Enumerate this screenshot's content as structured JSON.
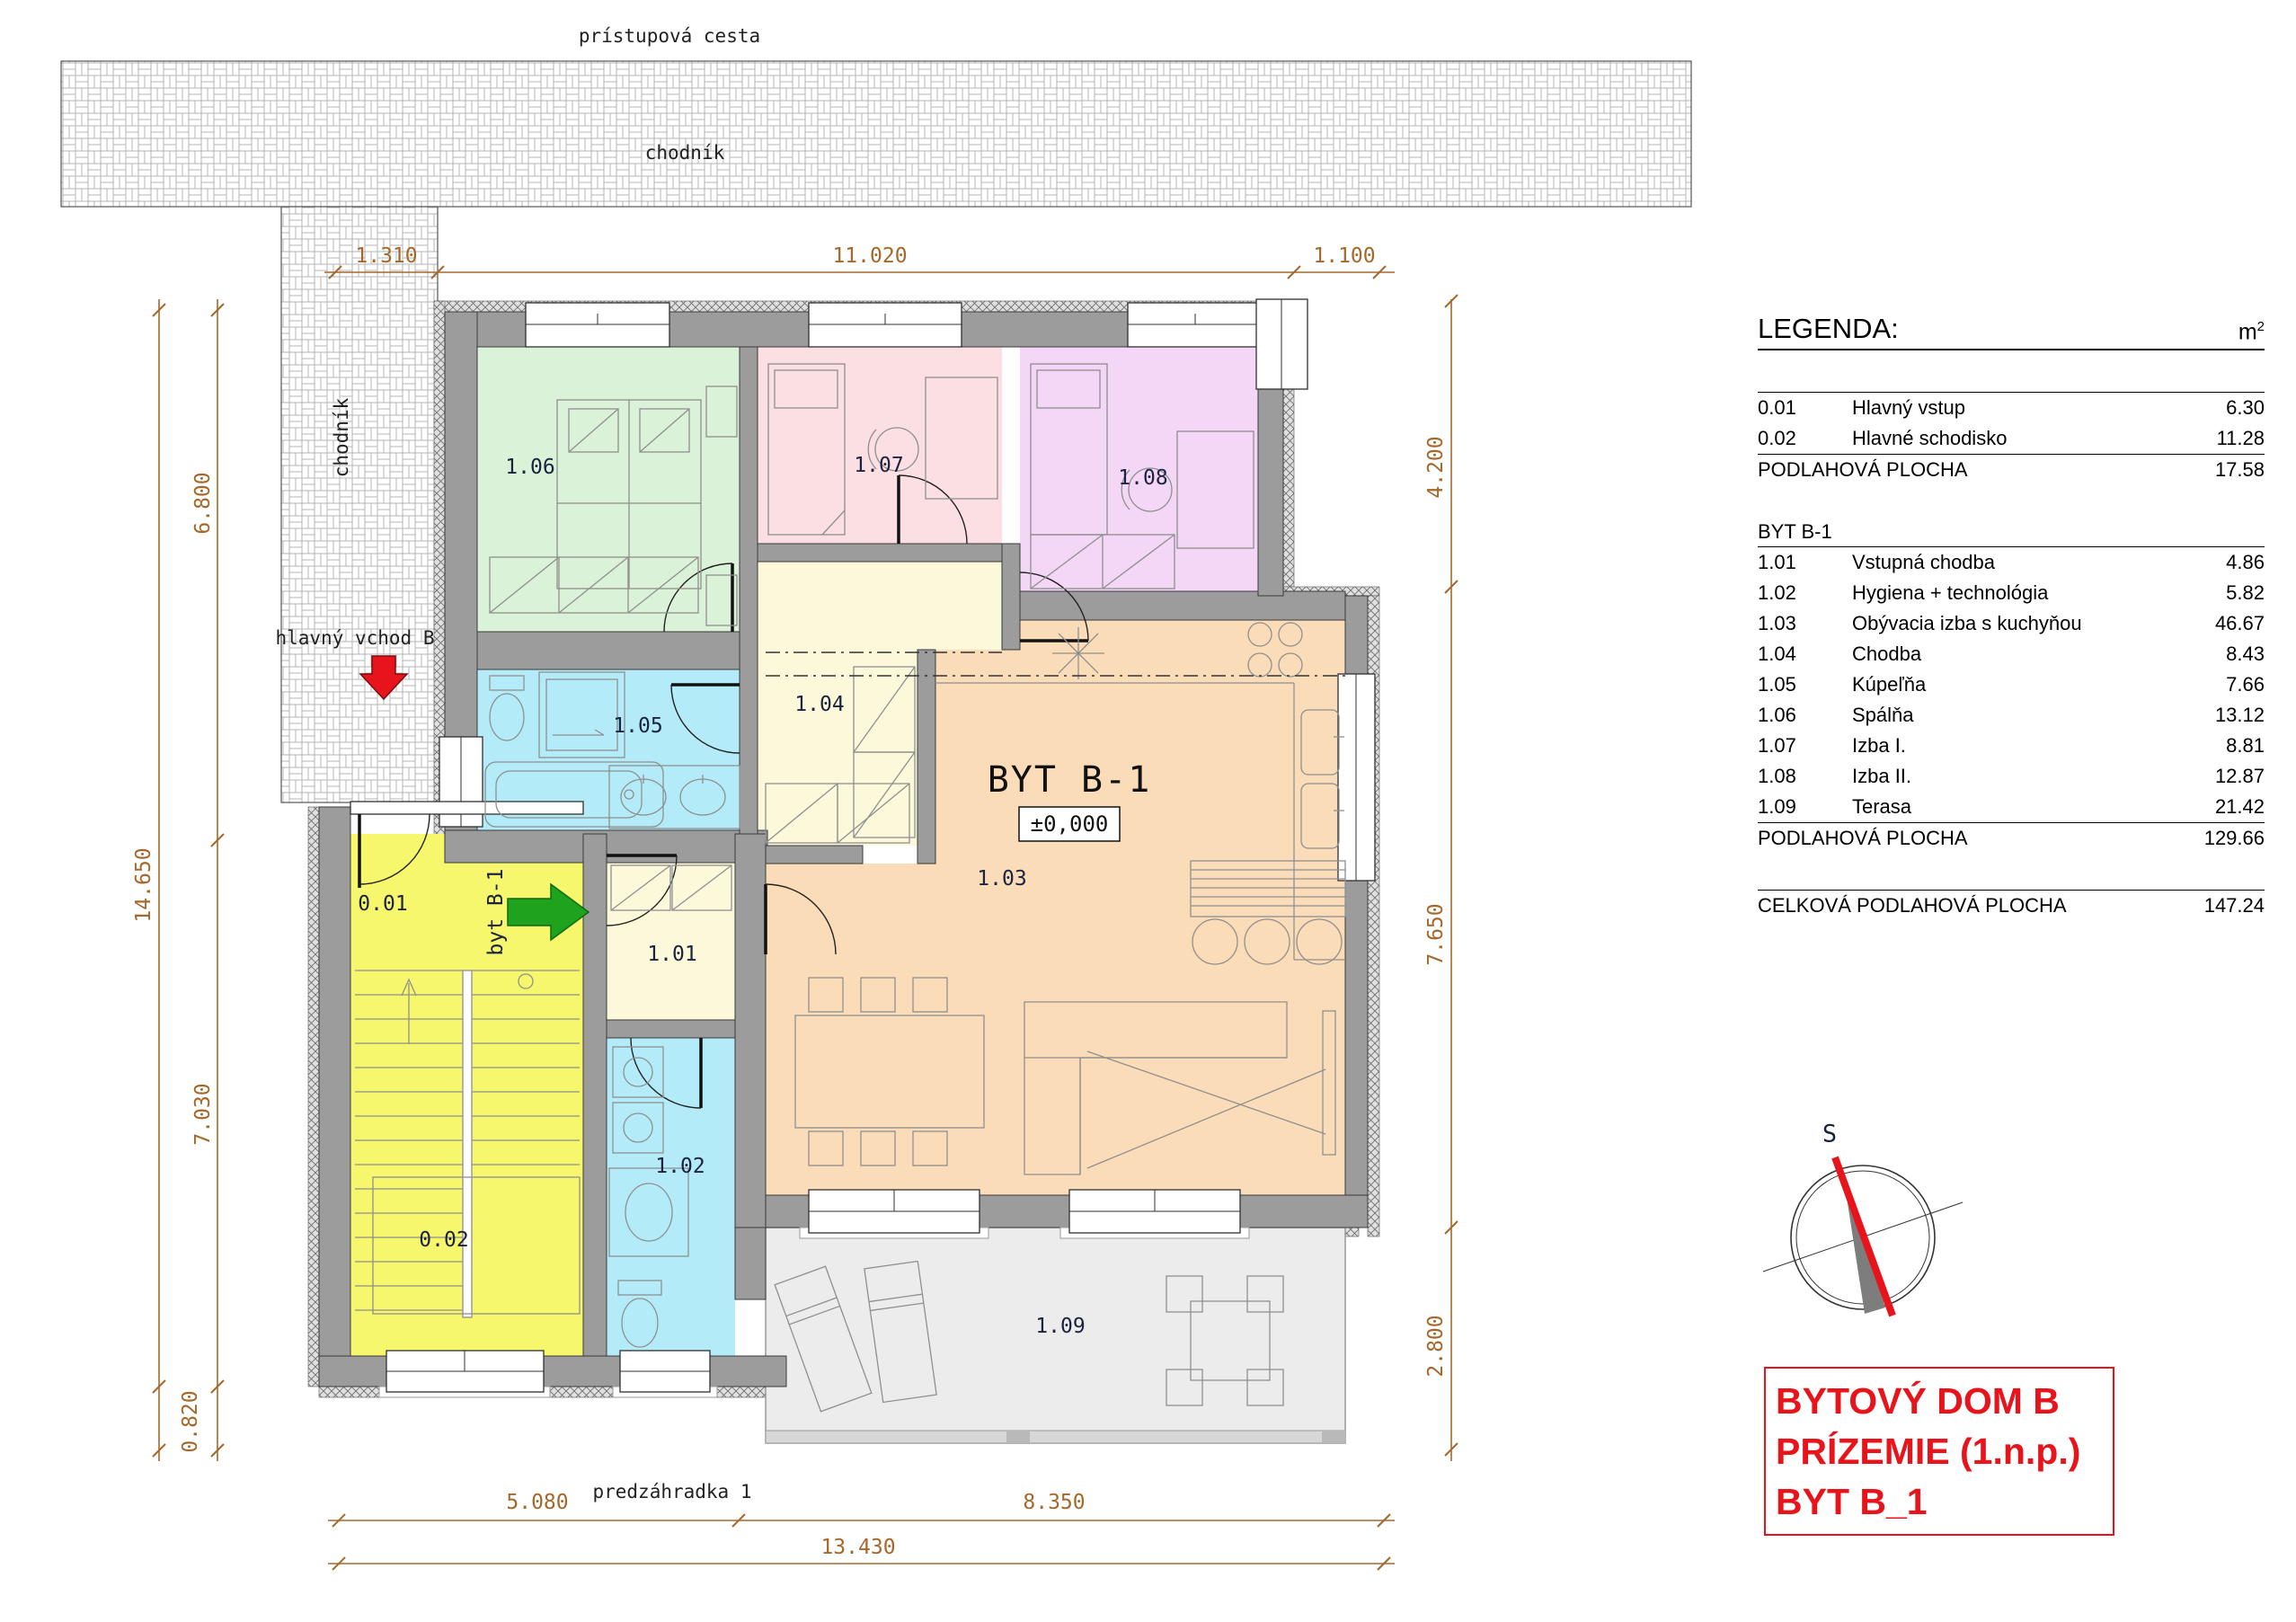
{
  "site": {
    "access_road": "prístupová cesta",
    "sidewalk_top": "chodník",
    "sidewalk_left": "chodník",
    "main_entrance": "hlavný vchod B",
    "front_garden": "predzáhradka 1"
  },
  "apartment": {
    "title": "BYT B-1",
    "level": "±0,000",
    "entry_arrow_label": "byt B-1"
  },
  "rooms": {
    "r001": {
      "code": "0.01",
      "color": "#f7f76d"
    },
    "r002": {
      "code": "0.02",
      "color": "#f7f76d"
    },
    "r101": {
      "code": "1.01",
      "color": "#fcf9da"
    },
    "r102": {
      "code": "1.02",
      "color": "#b3ecf8"
    },
    "r103": {
      "code": "1.03",
      "color": "#fadcb8"
    },
    "r104": {
      "code": "1.04",
      "color": "#fcf9da"
    },
    "r105": {
      "code": "1.05",
      "color": "#b3ecf8"
    },
    "r106": {
      "code": "1.06",
      "color": "#daf2d7"
    },
    "r107": {
      "code": "1.07",
      "color": "#fbdfe3"
    },
    "r108": {
      "code": "1.08",
      "color": "#f4d7f6"
    },
    "r109": {
      "code": "1.09",
      "color": "#ececec"
    }
  },
  "dims": {
    "d1310": "1.310",
    "d11020": "11.020",
    "d1100": "1.100",
    "d14650": "14.650",
    "d6800": "6.800",
    "d7030": "7.030",
    "d0820": "0.820",
    "d4200": "4.200",
    "d7650": "7.650",
    "d2800": "2.800",
    "d5080": "5.080",
    "d8350": "8.350",
    "d13430": "13.430"
  },
  "legend": {
    "title": "LEGENDA:",
    "unit_base": "m",
    "unit_sup": "2",
    "common_rows": [
      {
        "code": "0.01",
        "name": "Hlavný vstup",
        "area": "6.30"
      },
      {
        "code": "0.02",
        "name": "Hlavné schodisko",
        "area": "11.28"
      }
    ],
    "common_total_label": "PODLAHOVÁ PLOCHA",
    "common_total": "17.58",
    "byt_header": "BYT B-1",
    "byt_rows": [
      {
        "code": "1.01",
        "name": "Vstupná chodba",
        "area": "4.86"
      },
      {
        "code": "1.02",
        "name": "Hygiena + technológia",
        "area": "5.82"
      },
      {
        "code": "1.03",
        "name": "Obývacia izba s kuchyňou",
        "area": "46.67"
      },
      {
        "code": "1.04",
        "name": "Chodba",
        "area": "8.43"
      },
      {
        "code": "1.05",
        "name": "Kúpeľňa",
        "area": "7.66"
      },
      {
        "code": "1.06",
        "name": "Spálňa",
        "area": "13.12"
      },
      {
        "code": "1.07",
        "name": "Izba I.",
        "area": "8.81"
      },
      {
        "code": "1.08",
        "name": "Izba II.",
        "area": "12.87"
      },
      {
        "code": "1.09",
        "name": "Terasa",
        "area": "21.42"
      }
    ],
    "byt_total_label": "PODLAHOVÁ PLOCHA",
    "byt_total": "129.66",
    "grand_label": "CELKOVÁ PODLAHOVÁ PLOCHA",
    "grand_total": "147.24"
  },
  "compass": {
    "north_label": "S"
  },
  "title_block": {
    "line1": "BYTOVÝ DOM B",
    "line2": "PRÍZEMIE (1.n.p.)",
    "line3": "BYT B_1"
  },
  "colors": {
    "wall": "#9c9c9c",
    "dimension": "#a5682a",
    "accent_red": "#e8141c",
    "arrow_green": "#1fa31f"
  }
}
